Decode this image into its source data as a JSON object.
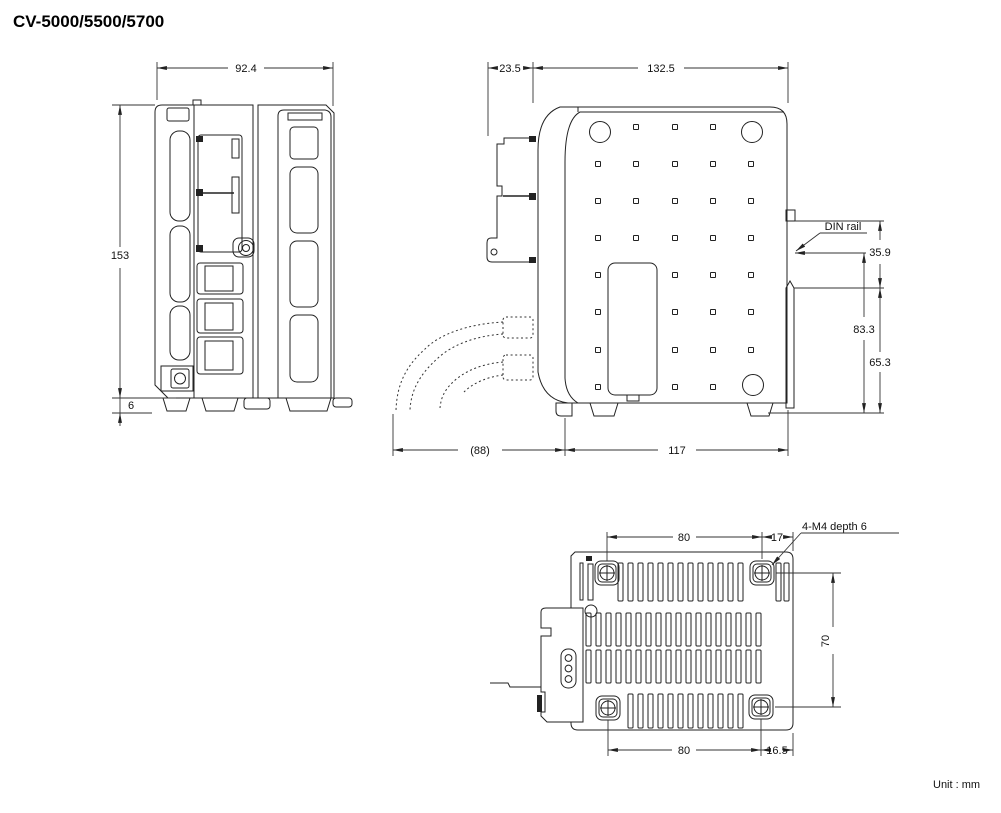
{
  "title": "CV-5000/5500/5700",
  "unit_note": "Unit : mm",
  "front_view": {
    "width": "92.4",
    "height": "153",
    "foot_height": "6"
  },
  "side_view": {
    "front_protrusion": "23.5",
    "depth": "132.5",
    "din_rail_label": "DIN rail",
    "din_offset_top": "35.9",
    "din_span": "83.3",
    "lower_span": "65.3",
    "cable_clearance": "(88)",
    "base_depth": "117"
  },
  "bottom_view": {
    "screw_pitch_top": "80",
    "rear_offset_top": "17",
    "screw_note": "4-M4 depth 6",
    "screw_pitch_vertical": "70",
    "screw_pitch_bottom": "80",
    "rear_offset_bottom": "16.5"
  }
}
